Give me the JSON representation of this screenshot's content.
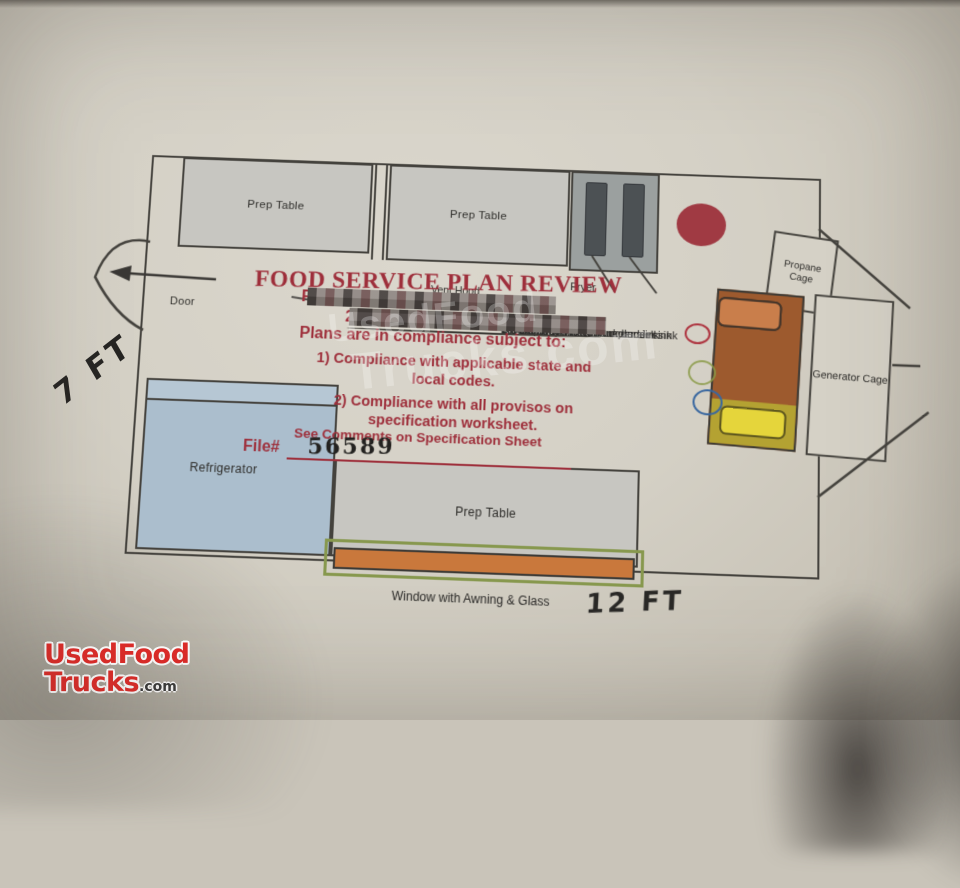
{
  "plan": {
    "title": "FOOD SERVICE PLAN REVIEW",
    "reviewer_label": "Reviewer",
    "redacted_prefix": "2",
    "compliance_intro": "Plans are in compliance subject to:",
    "condition1_line1": "1) Compliance with applicable state and",
    "condition1_line2": "local codes.",
    "condition2_line1": "2) Compliance with all provisos on",
    "condition2_line2": "specification worksheet.",
    "see_comments": "See Comments on Specification Sheet",
    "file_label": "File#",
    "file_number": "56589"
  },
  "equipment": {
    "prep_table_top_left": "Prep Table",
    "prep_table_top_middle": "Prep Table",
    "fryer": "Fryer",
    "vent_hood": "Vent Hood",
    "door": "Door",
    "refrigerator": "Refrigerator",
    "prep_table_bottom": "Prep Table",
    "window": "Window with Awning & Glass",
    "propane_cage": "Propane Cage",
    "generator_cage": "Generator Cage"
  },
  "plumbing_list": [
    "3 Compartment Sink",
    "7.5 Fresh Water Tank under sink",
    "10 Gal Grey Water Tank under sink",
    "2.5 Gal Water heater under sink",
    "On Demand Water Pump under sink"
  ],
  "dimensions": {
    "side": "7 FT",
    "front": "12 FT"
  },
  "watermark": {
    "line1": "UsedFood",
    "line2": "Trucks.com"
  },
  "logo": {
    "line1": "UsedFood",
    "line2": "Trucks",
    "suffix": ".com"
  },
  "colors": {
    "review_text_red": "#9e2f3b",
    "logo_red": "#e02b28",
    "refrigerator_blue": "#abbecd",
    "hot_unit_orange": "#c97e4b",
    "hot_unit_yellow": "#e5d53b",
    "window_bar_orange": "#c9783c",
    "window_frame_green": "#87984e",
    "sink_circle_red": "#a03a43"
  }
}
